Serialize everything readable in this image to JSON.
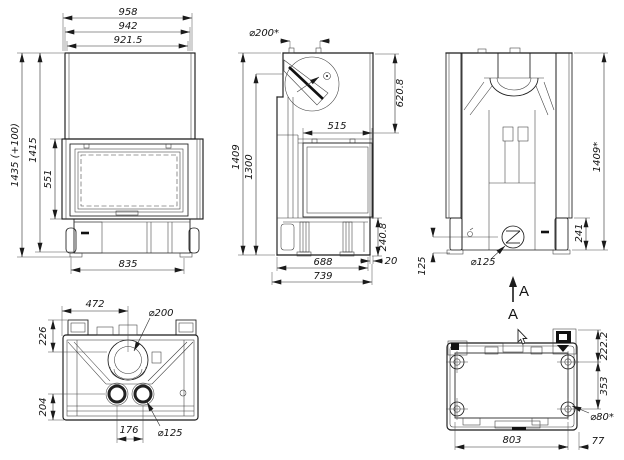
{
  "drawing_title": "fireplace-insert-dimension-drawing",
  "views": {
    "front": {
      "overall_width": "958",
      "width_mid": "942",
      "width_inner": "921.5",
      "overall_height": "1435 (+100)",
      "height": "1415",
      "glass_height": "551",
      "base_width": "835"
    },
    "side": {
      "flue_diameter": "⌀200*",
      "dome_height": "620.8",
      "glass_depth": "515",
      "height": "1409",
      "height_secondary": "1300",
      "base_height": "240.8",
      "rear_gap": "20",
      "base_depth": "688",
      "overall_depth": "739"
    },
    "rear": {
      "height": "1409*",
      "intake_height": "241",
      "intake_diameter": "⌀125",
      "foot_height": "125",
      "section_label": "A"
    },
    "top": {
      "flue_offset": "472",
      "flue_diameter": "⌀200",
      "depth_front": "226",
      "depth_rear": "204",
      "outlet_spacing": "176",
      "outlet_diameter": "⌀125"
    },
    "bottom": {
      "view_label": "A",
      "offset_top": "222.2",
      "hole_spacing": "353",
      "hole_diameter": "⌀80*",
      "width": "803",
      "side_offset": "77"
    }
  }
}
